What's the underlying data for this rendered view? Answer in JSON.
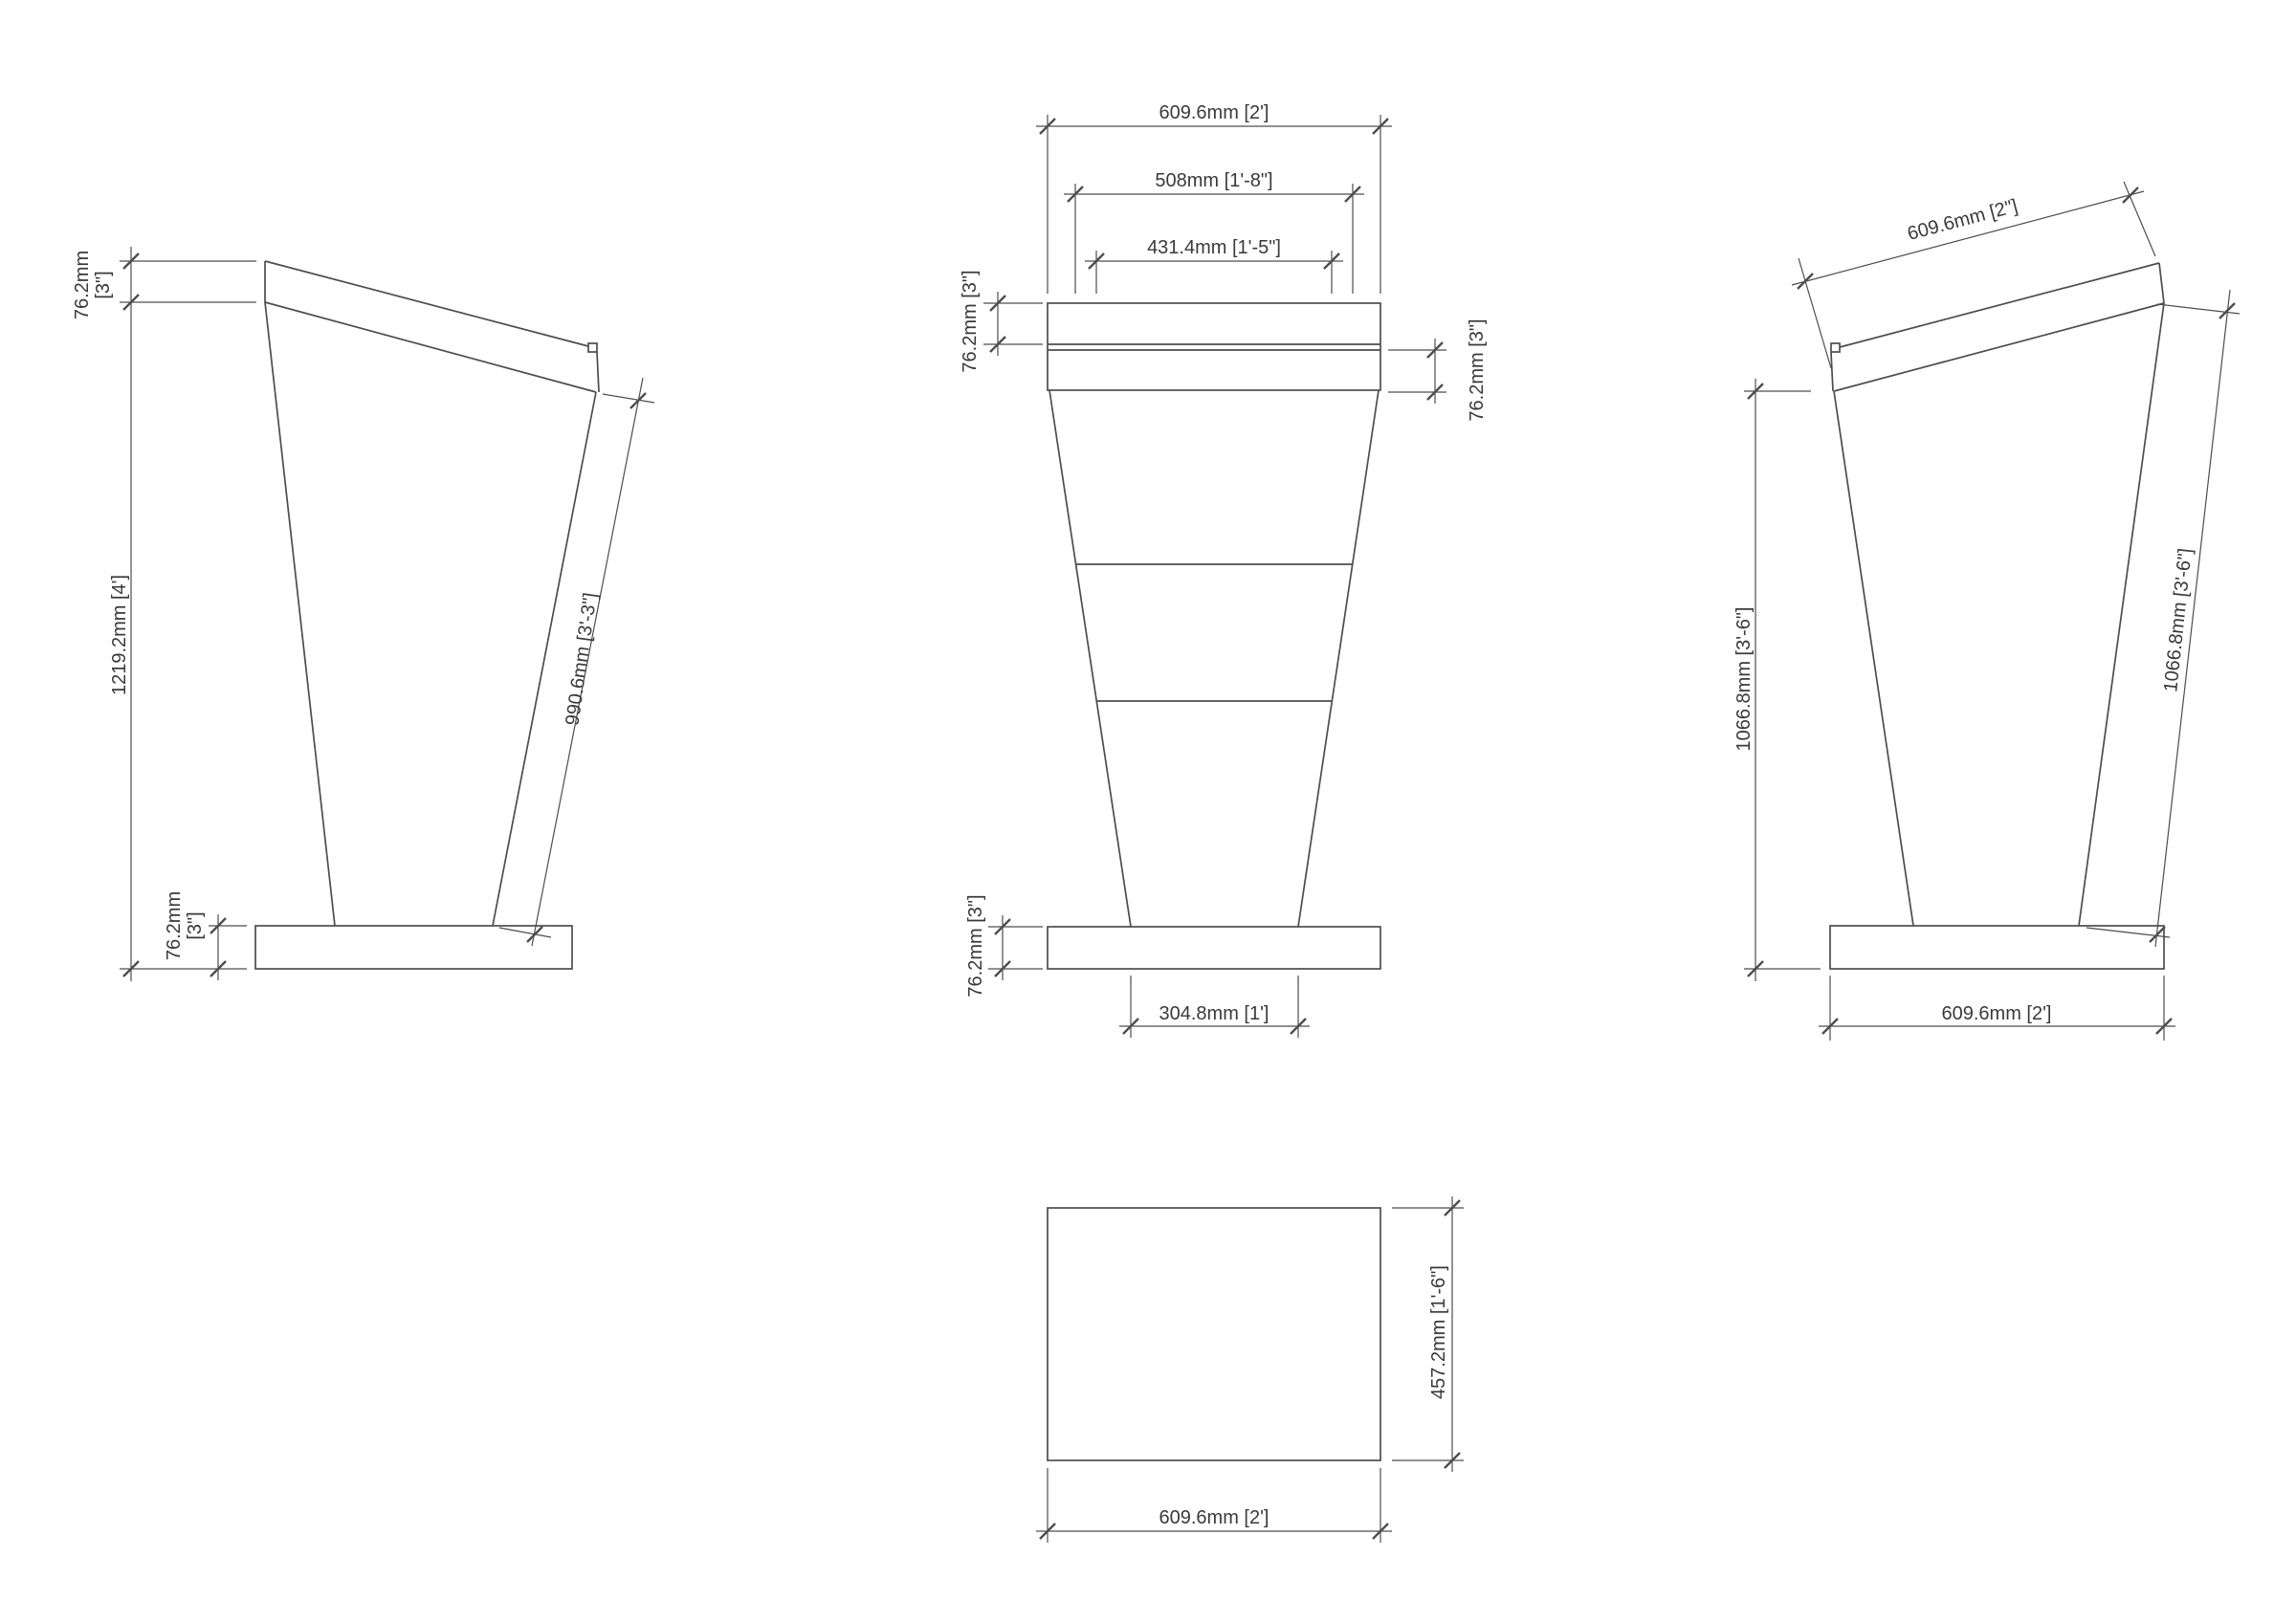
{
  "colors": {
    "background": "#ffffff",
    "line": "#4d4d4d",
    "text": "#3a3a3a"
  },
  "drawing_type": "lectern-orthographic-views",
  "views": {
    "side_left": {
      "name": "left side elevation",
      "dims": {
        "desk_thickness_mm": "76.2mm",
        "desk_thickness_imp": "[3\"]",
        "overall_height": "1219.2mm [4']",
        "back_edge_length": "990.6mm [3'-3\"]",
        "base_height_mm": "76.2mm",
        "base_height_imp": "[3\"]"
      }
    },
    "front": {
      "name": "front elevation",
      "dims": {
        "top_width": "609.6mm [2']",
        "shelf_width": "508mm [1'-8\"]",
        "inner_width": "431.4mm [1'-5\"]",
        "desk_front_thickness": "76.2mm [3\"]",
        "desk_rear_thickness": "76.2mm [3\"]",
        "base_thickness": "76.2mm [3\"]",
        "stem_width": "304.8mm [1']"
      }
    },
    "side_right": {
      "name": "right side elevation",
      "dims": {
        "desk_top_length": "609.6mm [2\"]",
        "height_to_desk": "1066.8mm [3'-6\"]",
        "front_edge_length": "1066.8mm [3'-6\"]",
        "base_width": "609.6mm [2']"
      }
    },
    "plan": {
      "name": "plan view",
      "dims": {
        "depth": "457.2mm [1'-6\"]",
        "width": "609.6mm [2']"
      }
    }
  }
}
